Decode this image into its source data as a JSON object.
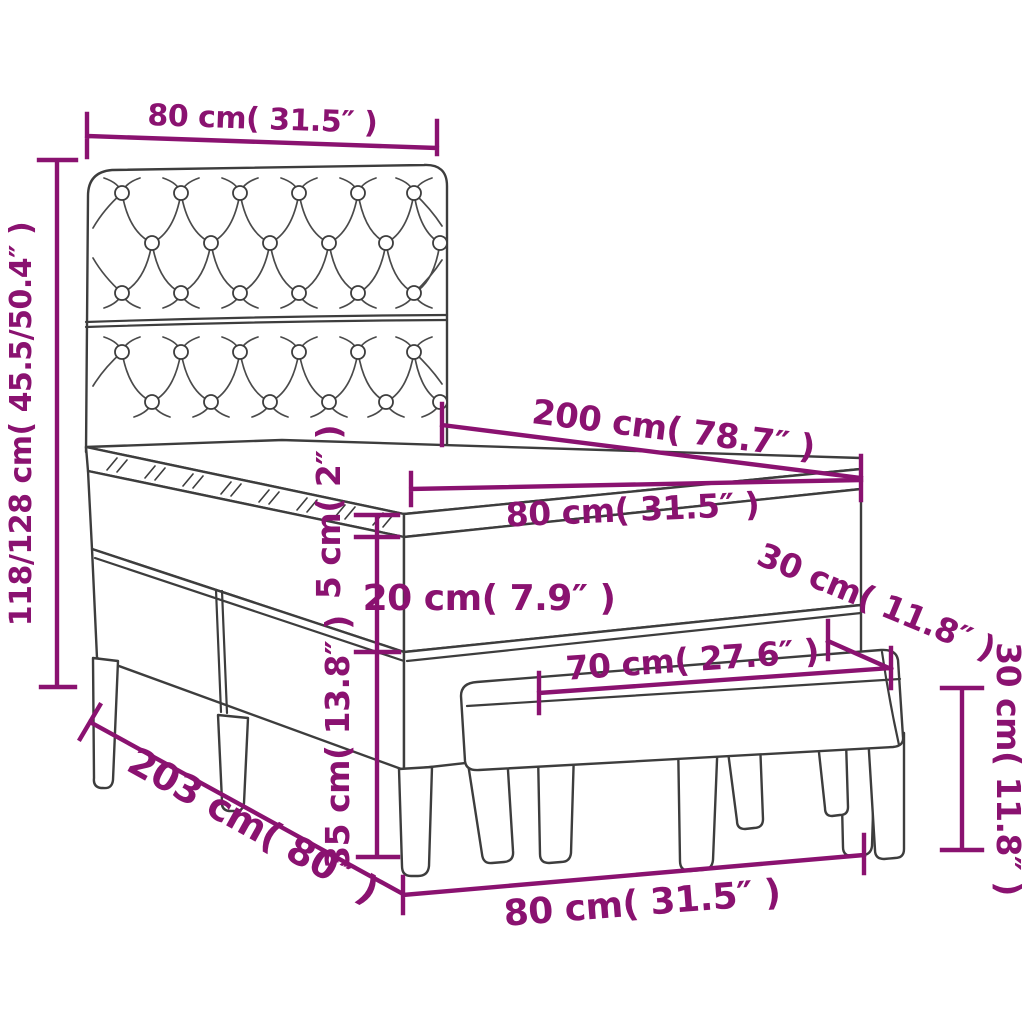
{
  "diagram": {
    "type": "furniture-dimension-diagram",
    "colors": {
      "dimension_accent": "#8A1270",
      "outline": "#3D3D3D",
      "background": "#FFFFFF"
    },
    "dims": {
      "headboard_width": "80 cm( 31.5″ )",
      "total_height": "118/128 cm( 45.5/50.4″ )",
      "bed_length": "200 cm( 78.7″ )",
      "mattress_width": "80 cm( 31.5″ )",
      "topper_thickness": "5 cm( 2″ )",
      "mattress_thickness": "20 cm( 7.9″ )",
      "base_height": "35 cm( 13.8″ )",
      "bed_depth": "203 cm( 80″ )",
      "floor_width": "80 cm( 31.5″ )",
      "bench_length": "70 cm( 27.6″ )",
      "bench_depth": "30 cm( 11.8″ )",
      "bench_height": "30 cm( 11.8″ )"
    }
  }
}
